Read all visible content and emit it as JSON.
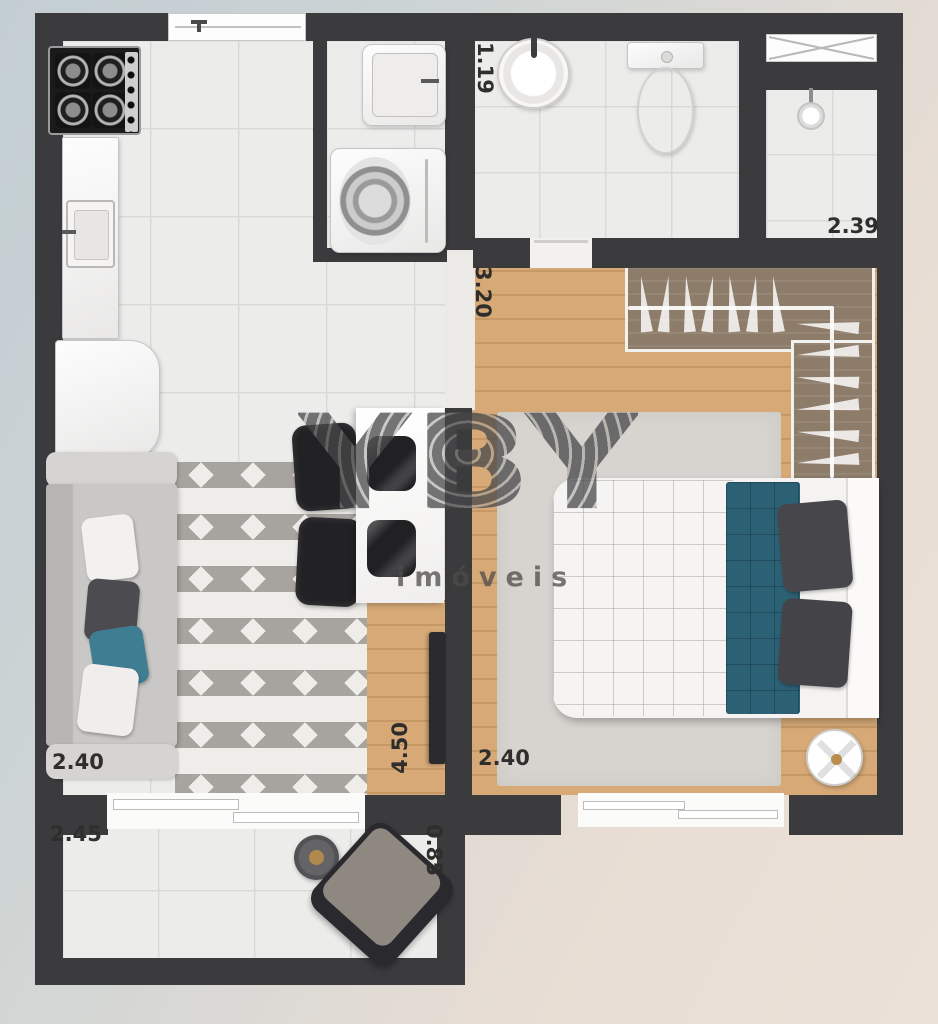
{
  "watermark": {
    "brand": "YBY",
    "tagline": "imóveis"
  },
  "measurements": {
    "bathroom_width": "1.19",
    "shower_width": "2.39",
    "hall_length": "3.20",
    "bedroom_width": "2.40",
    "living_width": "2.40",
    "living_length": "4.50",
    "balcony_width": "2.45",
    "balcony_depth": "0.85"
  },
  "colors": {
    "wall": "#3b3b3d",
    "wood_floor": "#d6a977",
    "closet_floor": "#8d7c6a",
    "accent_teal": "#2c6074",
    "tile": "#ececeb",
    "exterior_blue": "#c3ced3",
    "exterior_beige": "#ece1d8"
  },
  "fixtures": {
    "kitchen": [
      "stove-icon",
      "counter",
      "kitchen-sink-icon",
      "refrigerator-icon"
    ],
    "laundry": [
      "laundry-tank-icon",
      "washing-machine-icon"
    ],
    "bathroom": [
      "round-sink-icon",
      "toilet-icon",
      "shower-head-icon",
      "window-x-icon"
    ],
    "bedroom": [
      "double-bed",
      "wardrobe-hangers",
      "round-side-table"
    ],
    "living": [
      "sofa",
      "chevron-rug",
      "dining-table",
      "dining-chairs",
      "tv-rack"
    ],
    "balcony": [
      "armchair",
      "round-coffee-table",
      "sliding-door"
    ]
  }
}
